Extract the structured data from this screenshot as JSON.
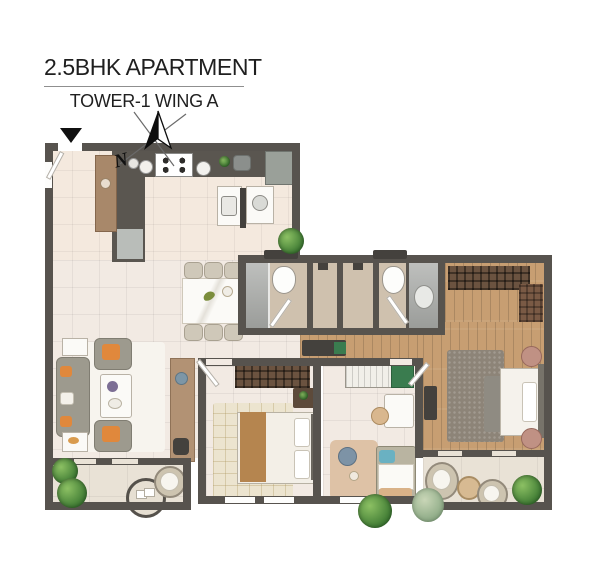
{
  "header": {
    "title": "2.5BHK APARTMENT",
    "subtitle": "TOWER-1 WING A"
  },
  "compass": {
    "north_label": "N"
  },
  "colors": {
    "wall": "#57534e",
    "tile_floor": "#f2eae3",
    "kitchen_floor": "#f4e9de",
    "wood_floor": "#c79e72",
    "balcony_floor": "#e9e2d6",
    "bath_floor": "#cfc1ae",
    "shower": "#a8aaa7",
    "accent_orange": "#e0883c",
    "plant_green": "#3e7a33",
    "title_text": "#1f1f1f"
  }
}
